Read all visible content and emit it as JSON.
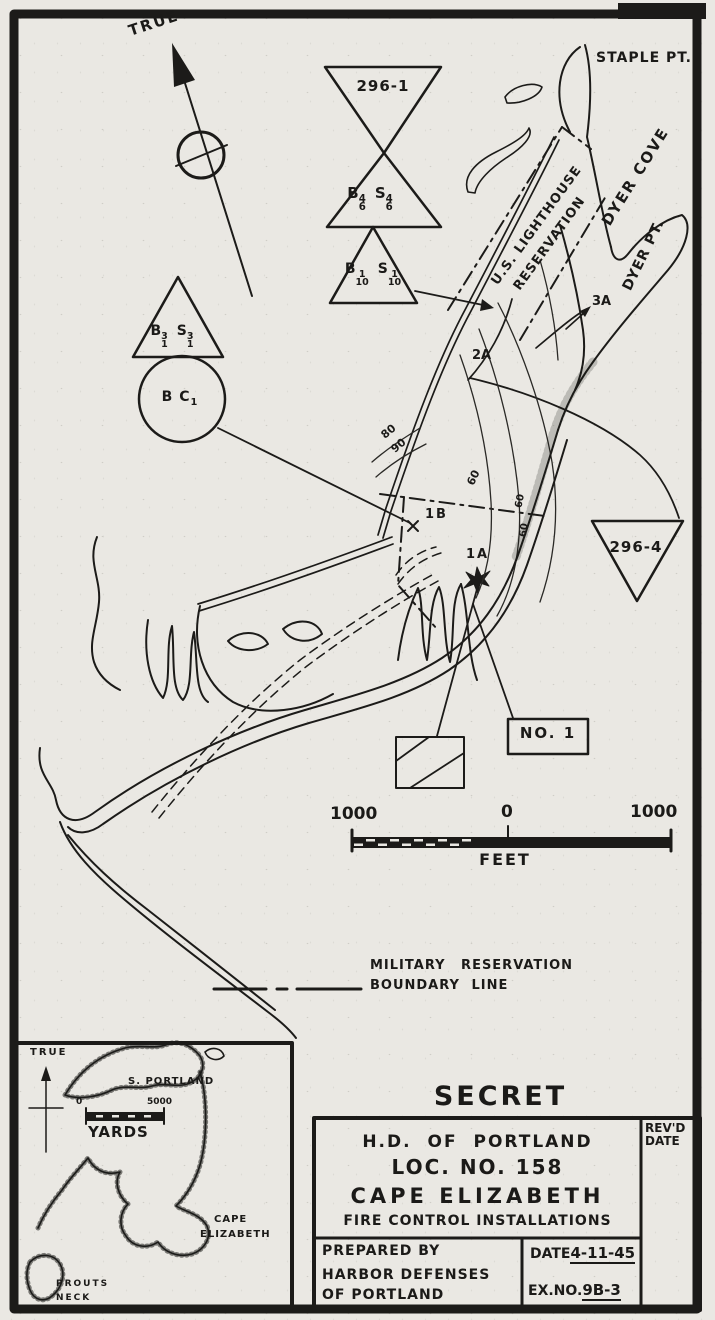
{
  "north": {
    "label": "TRUE"
  },
  "places": {
    "staple_pt": "STAPLE PT.",
    "dyer_cove": "DYER COVE",
    "dyer_pt": "DYER PT.",
    "lighthouse_1": "U.S. LIGHTHOUSE",
    "lighthouse_2": "RESERVATION"
  },
  "stations": {
    "bowtie": {
      "number": "296-1",
      "b": "B",
      "b_sup": "4",
      "b_sub": "6",
      "s": "S",
      "s_sup": "4",
      "s_sub": "6"
    },
    "tri10": {
      "b": "B",
      "b_sup": "1",
      "b_sub": "10",
      "s": "S",
      "s_sup": "1",
      "s_sub": "10"
    },
    "tri1": {
      "b": "B",
      "b_sup": "3",
      "b_sub": "1",
      "s": "S",
      "s_sup": "3",
      "s_sub": "1"
    },
    "bc": {
      "text": "B C",
      "sub": "1"
    },
    "tri4": {
      "number": "296-4"
    },
    "pt_3a": "3A",
    "pt_2a": "2A",
    "pt_1b": "1B",
    "pt_1a": "1A",
    "no1": "NO. 1"
  },
  "contours": {
    "c80": "80",
    "c90": "90",
    "c60a": "60",
    "c60b": "60",
    "c60c": "60"
  },
  "scale": {
    "left": "1000",
    "zero": "0",
    "right": "1000",
    "unit": "FEET"
  },
  "legend": {
    "line1": "MILITARY RESERVATION",
    "line2": "BOUNDARY LINE"
  },
  "inset": {
    "true_label": "TRUE",
    "s_portland": "S. PORTLAND",
    "zero": "0",
    "max": "5000",
    "unit": "YARDS",
    "cape_1": "CAPE",
    "cape_2": "ELIZABETH",
    "prouts_1": "PROUTS",
    "prouts_2": "NECK"
  },
  "title_block": {
    "classification": "SECRET",
    "line1": "H.D. OF PORTLAND",
    "line2": "LOC. NO. 158",
    "line3": "CAPE ELIZABETH",
    "line4": "FIRE CONTROL INSTALLATIONS",
    "prepared_1": "PREPARED BY",
    "prepared_2": "HARBOR DEFENSES",
    "prepared_3": "OF PORTLAND",
    "date_label": "DATE",
    "date_value": "4-11-45",
    "ex_label": "EX.NO.",
    "ex_value": "9B-3",
    "revd_1": "REV'D",
    "revd_2": "DATE"
  },
  "colors": {
    "ink": "#1c1b19",
    "paper": "#eae8e3"
  }
}
